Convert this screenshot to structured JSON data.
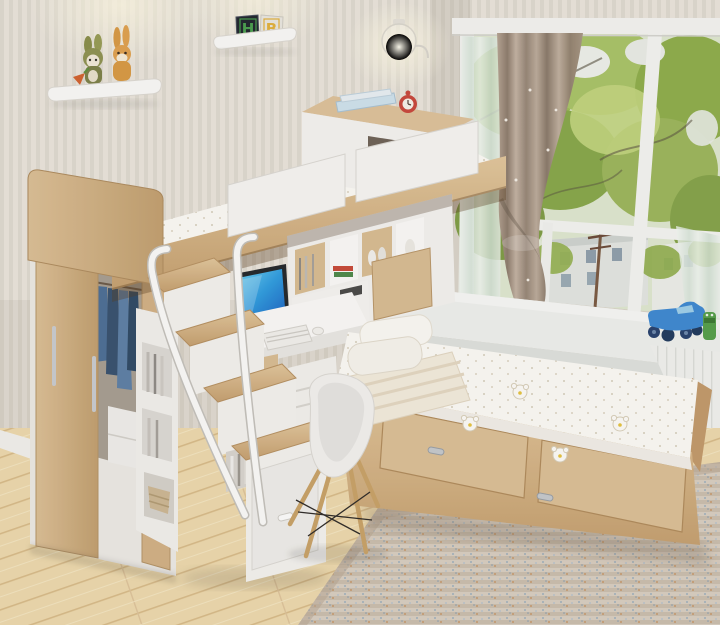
{
  "scene": {
    "description": "Kids bedroom photo: loft bunk bed with wardrobe, storage staircase, desk and platform bed beside a bay window",
    "letter_blocks": [
      "H",
      "B"
    ],
    "objects": [
      "striped-wallpaper",
      "wall-shelf-plush-bunnies",
      "letter-blocks-shelf",
      "wall-lamp",
      "bay-window",
      "tied-curtain",
      "sheer-curtain",
      "trees-outside",
      "building-outside",
      "window-sill",
      "toy-truck-blue",
      "toy-figure-green",
      "loft-bunk-bed",
      "guard-rails",
      "headboard-cabinet",
      "alarm-clock-red",
      "books",
      "wardrobe-sliding-doors",
      "hanging-clothes",
      "storage-staircase",
      "stair-handrails",
      "bookshelf-cubbies",
      "desk",
      "monitor",
      "keyboard",
      "mouse",
      "potted-plant",
      "shell-chair",
      "platform-bed",
      "bed-drawers",
      "pillows",
      "striped-duvet",
      "bear-print-mattress",
      "woven-rug",
      "wood-floor"
    ],
    "palette": {
      "wall_stripe_light": "#f3efe8",
      "wall_stripe_dark": "#e5e0d6",
      "wood": "#d9bd92",
      "wood_dark": "#c3a071",
      "white_furniture": "#f6f5f2",
      "floor": "#eedaad",
      "foliage": "#9cb75c",
      "curtain_taupe": "#b0a090",
      "toy_truck_blue": "#3e8ad2",
      "clock_red": "#c9473b",
      "rug": "#d8cec0",
      "denim_blue": "#4a6a8f",
      "plant_green": "#55933f",
      "screen_blue": "#2f9de0",
      "block_letter_green": "#4aa04f",
      "block_letter_yellow": "#e2b23c"
    }
  }
}
